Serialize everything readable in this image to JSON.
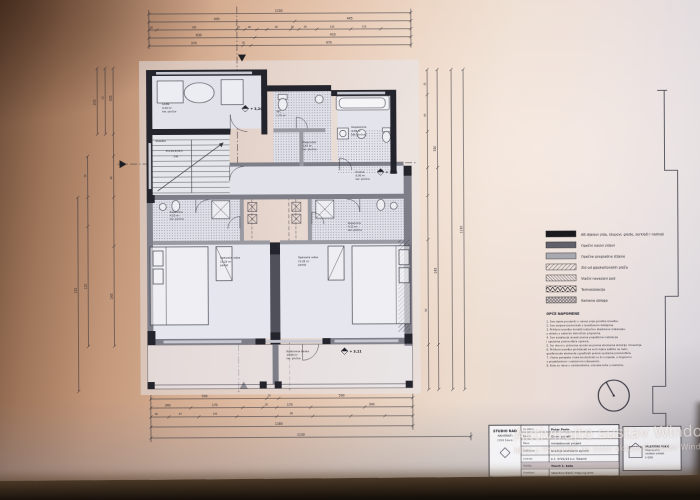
{
  "overlay": {
    "watermark_line1": "Aktivirajte sustav Windows",
    "watermark_line2": "Idite u Postavke da biste aktivirali sustav Windows."
  },
  "plan": {
    "rooms": {
      "loggia": {
        "name": "Lođa",
        "area": "9,30 m²",
        "floor": "ker. pločice"
      },
      "stairs": {
        "name": "Stubište",
        "riser": "15×16,4/30,5",
        "width": "240"
      },
      "wc": {
        "name": "WC",
        "area": "1,70 m²"
      },
      "hall_top": {
        "name": "Pretprostor",
        "area": "1,62 m²",
        "floor": "ker. pločice"
      },
      "bathroom": {
        "name": "Kupaonica",
        "area": "4,76 m²",
        "floor": "ker. pločice"
      },
      "corridor": {
        "name": "Hodnik",
        "area": "8,06 m²",
        "floor": "ker. pločice"
      },
      "bath_left": {
        "name": "Kupaonica",
        "area": "4,10 m²",
        "floor": "ker. pločice"
      },
      "bath_right": {
        "name": "Kupaonica",
        "area": "4,12 m²",
        "floor": "ker. pločice"
      },
      "bedroom_left": {
        "name": "Spavaća soba",
        "area": "23,26 m²",
        "floor": "parket"
      },
      "bedroom_right": {
        "name": "Spavaća soba",
        "area": "21,06 m²",
        "floor": "parket"
      },
      "terrace": {
        "name": "Natkrivena terasa",
        "area": "10,66 m²",
        "floor": "ker. pločice"
      }
    },
    "levels": {
      "l1": "+ 3,24",
      "l2": "+ 3,11",
      "l3": "+ 3,11"
    },
    "dims": {
      "top": [
        "1130",
        "495",
        "445",
        "30",
        "390",
        "25",
        "40",
        "90",
        "30",
        "95",
        "130",
        "110",
        "630",
        "410",
        "370",
        "30",
        "470"
      ],
      "left": [
        "335",
        "23",
        "205",
        "90",
        "245",
        "30",
        "120",
        "152"
      ],
      "right": [
        "35",
        "90",
        "350",
        "245",
        "90",
        "1130"
      ],
      "bottom": [
        "590",
        "25",
        "590",
        "340",
        "170",
        "30",
        "170",
        "340",
        "90",
        "87",
        "143",
        "98",
        "1180",
        "1130"
      ]
    }
  },
  "legend": {
    "items": [
      {
        "label": "AB dijelovi zida, stupovi, grede, serklaži i nadvoji",
        "swatch": "solid-black"
      },
      {
        "label": "Opečni nosivi zidovi",
        "swatch": "solid-dark-gray"
      },
      {
        "label": "Opečne pregradne stijene",
        "swatch": "solid-gray"
      },
      {
        "label": "Zid od gipskartonskih ploča",
        "swatch": "diag-hatch"
      },
      {
        "label": "Vlačni nevezani pod",
        "swatch": "diag-hatch-dense"
      },
      {
        "label": "Termoizolacija",
        "swatch": "zigzag"
      },
      {
        "label": "Kamena obloga",
        "swatch": "cross-hatch"
      }
    ]
  },
  "notes": {
    "title": "OPĆE NAPOMENE",
    "lines": [
      "1. Sve mjere provjeriti u naravi prije početka izvedbe.",
      "2. Sve izmjere kontrolirati s izvedbenim detaljima.",
      "3. Prilikom izvedbe koristiti isključivo atestirane materijale,",
      "    u skladu s važećim tehničkim propisima.",
      "4. Sve instalacije izvesti prema projektima instalacija",
      "    i uputama proizvođača opreme.",
      "5. Svi otvori u zidovima izvode se prema shemama stolarije i bravarije.",
      "6. Prilikom izvedbe pridržavati se svih mjera zaštite na radu;",
      "    građevinske elemente ugrađivati prema uputama proizvođača.",
      "7. Visine parapeta i kote kontrolirati na licu mjesta, u dogovoru",
      "    s projektantom i nadzornim inženjerom.",
      "8. Kote su dane u centimetrima, visinske kote u metrima."
    ]
  },
  "titleblock": {
    "office": {
      "l1": "STUDIO RAD",
      "l2": "ARHITEKTI",
      "l3": "22000 Šibenik"
    },
    "rows": [
      {
        "label": "Investitor:",
        "value": "Petar Perin"
      },
      {
        "label": "Razina:",
        "value": "Glavni projekt"
      },
      {
        "label": "Mapa:",
        "value": "Arhitektonski projekt"
      },
      {
        "label": "Građevina:",
        "value": "Gradnja stambene zgrade"
      },
      {
        "label": "Lokacija:",
        "value": "k.č. 3721/14 k.o. Šibenik"
      },
      {
        "label": "Sadržaj:",
        "value": "Tlocrt 1. kata"
      },
      {
        "label": "Projektant:",
        "value": "Valentino Rakić mag.ing.arch."
      }
    ],
    "bottom": {
      "c0a": "Datum:",
      "c0b": "veljača 2021.",
      "c1a": "Mjerilo:",
      "c1b": "1:50",
      "c2a": "Broj projekta:",
      "c2b": "5099-GD/21-7A",
      "c3a": "List:",
      "c3b": "3"
    },
    "stamp": {
      "l1": "VALENTINO RAKIĆ",
      "l2": "mag.ing.arch.",
      "l3": "ovlašteni arhitekt",
      "l4": "A 4248"
    }
  }
}
